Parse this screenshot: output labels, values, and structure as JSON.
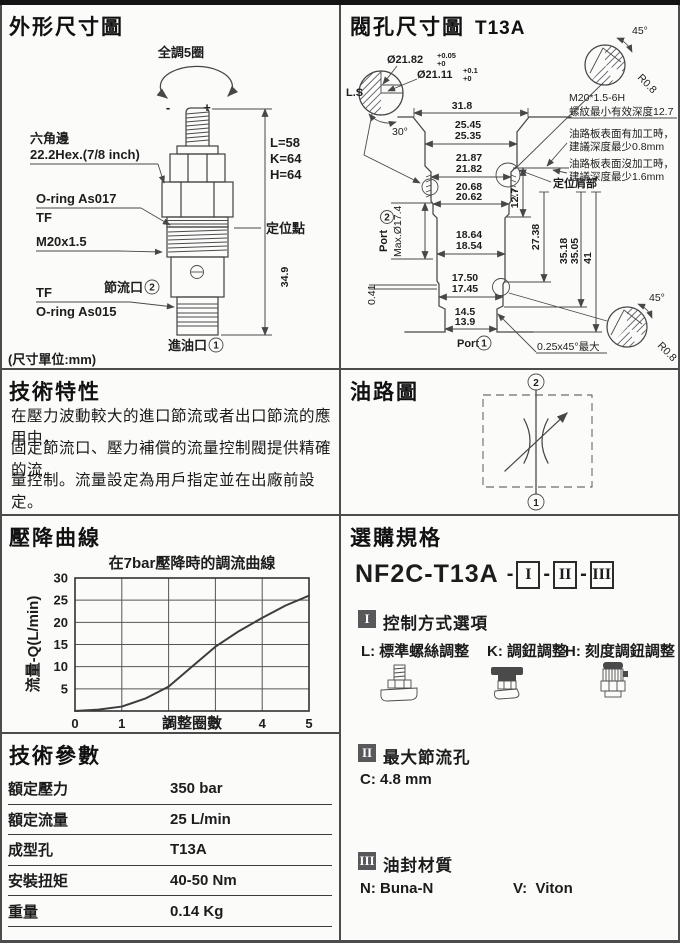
{
  "colors": {
    "ink": "#1c1c1c",
    "line": "#474747",
    "badge": "#58585a",
    "border": "#4c4c4c"
  },
  "outline": {
    "title": "外形尺寸圖",
    "adjust": "全調5圈",
    "minus": "-",
    "plus": "+",
    "hex1": "六角邊",
    "hex2": "22.2Hex.(7/8 inch)",
    "dimL": "L=58",
    "dimK": "K=64",
    "dimH": "H=64",
    "oring1": "O-ring As017",
    "tf1": "TF",
    "thread": "M20x1.5",
    "locate": "定位點",
    "throttle": "節流口",
    "throttle_num": "2",
    "tf2": "TF",
    "oring2": "O-ring As015",
    "h349": "34.9",
    "inlet": "進油口",
    "inlet_num": "1",
    "unit": "(尺寸單位:mm)"
  },
  "cavity": {
    "title": "閥孔尺寸圖",
    "code": "T13A",
    "ls": "L.S",
    "dia1": "Ø21.82",
    "dia1t": "+0.05",
    "dia1b": "+0",
    "dia2": "Ø21.11",
    "dia2t": "+0.1",
    "dia2b": "+0",
    "a30": "30°",
    "a45t": "45°",
    "r08t": "R0.8",
    "a45b": "45°",
    "r08b": "R0.8",
    "m20": "M20*1.5-6H",
    "m20depth": "螺紋最小有效深度12.7",
    "n1a": "油路板表面有加工時，",
    "n1b": "建議深度最少0.8mm",
    "n2a": "油路板表面沒加工時，",
    "n2b": "建議深度最少1.6mm",
    "shoulder": "定位肩部",
    "w318": "31.8",
    "w2545": "25.45",
    "w2535": "25.35",
    "w2187": "21.87",
    "w2182": "21.82",
    "w2068": "20.68",
    "w2062": "20.62",
    "w1864": "18.64",
    "w1854": "18.54",
    "w1750": "17.50",
    "w1745": "17.45",
    "w145": "14.5",
    "w139": "13.9",
    "h127": "12.7",
    "h2738": "27.38",
    "h3518": "35.18",
    "h3505": "35.05",
    "h41": "41",
    "port2": "Port",
    "port2_num": "2",
    "maxd": "Max.Ø17.4",
    "t041": "0.41",
    "port1": "Port",
    "port1_num": "1",
    "chamfer": "0.25x45°最大"
  },
  "features": {
    "title": "技術特性",
    "line1": "在壓力波動較大的進口節流或者出口節流的應用中，",
    "line2": "固定節流口、壓力補償的流量控制閥提供精確的流",
    "line3": "量控制。流量設定為用戶指定並在出廠前設定。"
  },
  "circuit": {
    "title": "油路圖",
    "top_num": "2",
    "bottom_num": "1"
  },
  "curve": {
    "title": "壓降曲線"
  },
  "chart_data": {
    "type": "line",
    "title": "在7bar壓降時的調流曲線",
    "xlabel": "調整圈數",
    "ylabel": "流量-Q(L/min)",
    "xlim": [
      0,
      5
    ],
    "ylim": [
      0,
      30
    ],
    "xticks": [
      0,
      1,
      2,
      3,
      4,
      5
    ],
    "yticks": [
      5,
      10,
      15,
      20,
      25,
      30
    ],
    "grid": true,
    "legend": false,
    "x": [
      0,
      0.5,
      1,
      1.5,
      2,
      2.5,
      3,
      3.5,
      4,
      4.5,
      5
    ],
    "y": [
      0,
      0.3,
      1,
      2.8,
      5.5,
      10,
      14.5,
      18,
      21,
      23.8,
      26
    ]
  },
  "ordering": {
    "title": "選購規格",
    "model": "NF2C-T13A",
    "dash": "-",
    "opt1": "I",
    "opt2": "II",
    "opt3": "III",
    "s1": {
      "num": "I",
      "title": "控制方式選項",
      "o1c": "L:",
      "o1": "標準螺絲調整",
      "o2c": "K:",
      "o2": "調鈕調整",
      "o3c": "H:",
      "o3": "刻度調鈕調整"
    },
    "s2": {
      "num": "II",
      "title": "最大節流孔",
      "val": "C: 4.8 mm"
    },
    "s3": {
      "num": "III",
      "title": "油封材質",
      "nc": "N:",
      "n": "Buna-N",
      "vc": "V:",
      "v": "Viton"
    }
  },
  "params": {
    "title": "技術參數",
    "rows": [
      {
        "label": "額定壓力",
        "value": "350 bar"
      },
      {
        "label": "額定流量",
        "value": "25 L/min"
      },
      {
        "label": "成型孔",
        "value": "T13A"
      },
      {
        "label": "安裝扭矩",
        "value": "40-50 Nm"
      },
      {
        "label": "重量",
        "value": "0.14 Kg"
      }
    ]
  }
}
